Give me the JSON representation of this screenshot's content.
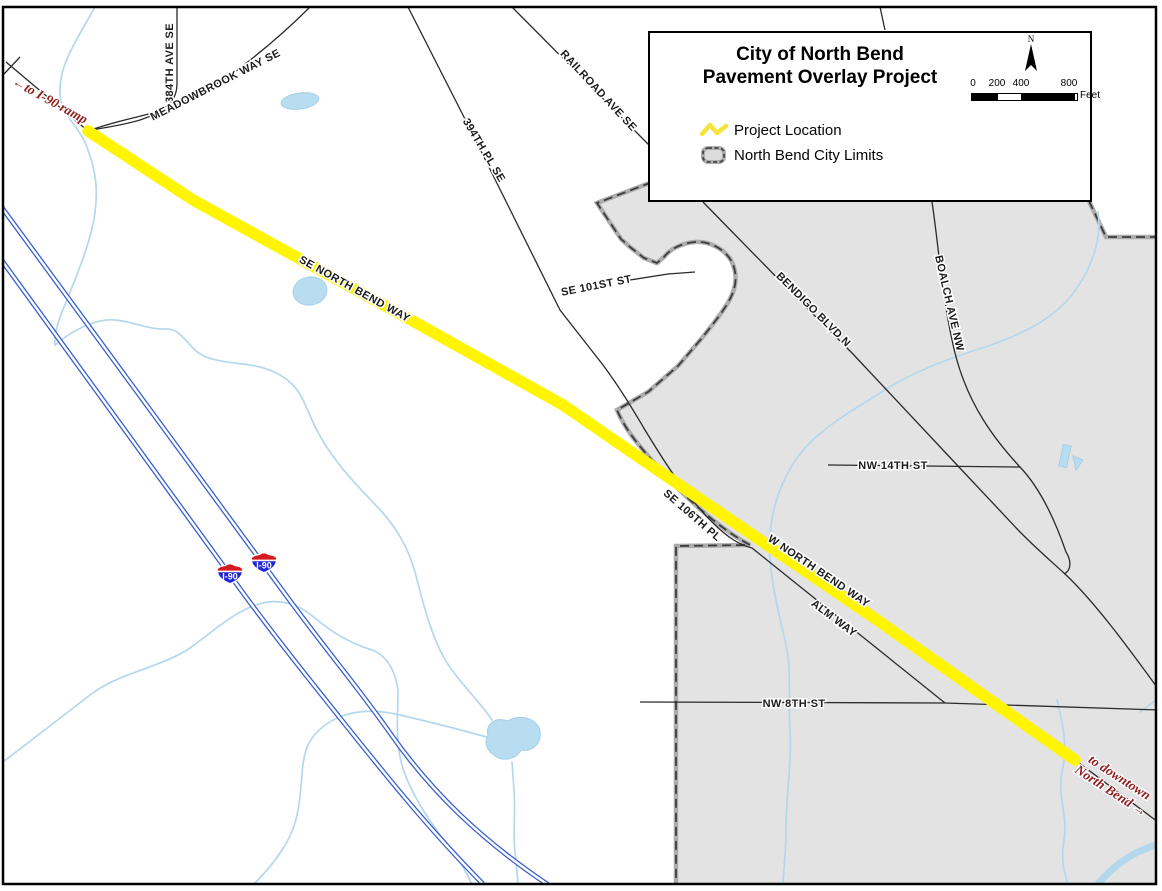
{
  "map_title": {
    "line1": "City of North Bend",
    "line2": "Pavement Overlay Project"
  },
  "legend": {
    "north_arrow_label": "N",
    "scale_bar": {
      "tick_labels": [
        "0",
        "200",
        "400",
        "800"
      ],
      "unit_label": "Feet"
    },
    "items": [
      {
        "label": "Project Location",
        "symbol": "yellow-zigzag-line"
      },
      {
        "label": "North Bend City Limits",
        "symbol": "gray-dashed-rounded-rect"
      }
    ]
  },
  "road_labels": [
    "384TH AVE SE",
    "MEADOWBROOK WAY SE",
    "RAILROAD AVE SE",
    "394TH PL SE",
    "SE 101ST ST",
    "SE NORTH BEND WAY",
    "BENDIGO BLVD N",
    "BOALCH AVE NW",
    "NW 14TH ST",
    "SE 106TH PL",
    "W NORTH BEND WAY",
    "ALM WAY",
    "NW 8TH ST"
  ],
  "annotations": {
    "to_i90_ramp": "←to I-90 ramp",
    "to_downtown_line1": "to downtown",
    "to_downtown_line2": "North Bend →"
  },
  "highway_shields": [
    {
      "label": "I-90"
    },
    {
      "label": "I-90"
    }
  ],
  "colors": {
    "project_highlight_yellow": "#FFF500",
    "city_limits_fill": "#E3E3E3",
    "city_limits_border_dash": "#3D3D3D",
    "city_limits_border_casing": "#ACACAC",
    "freeway_blue": "#3A60CC",
    "stream_blue": "#B3D8EE",
    "road_black": "#2A2A2A",
    "annotation_red": "#8E1D1D",
    "shield_red": "#D6191E",
    "shield_blue": "#2026D6"
  }
}
